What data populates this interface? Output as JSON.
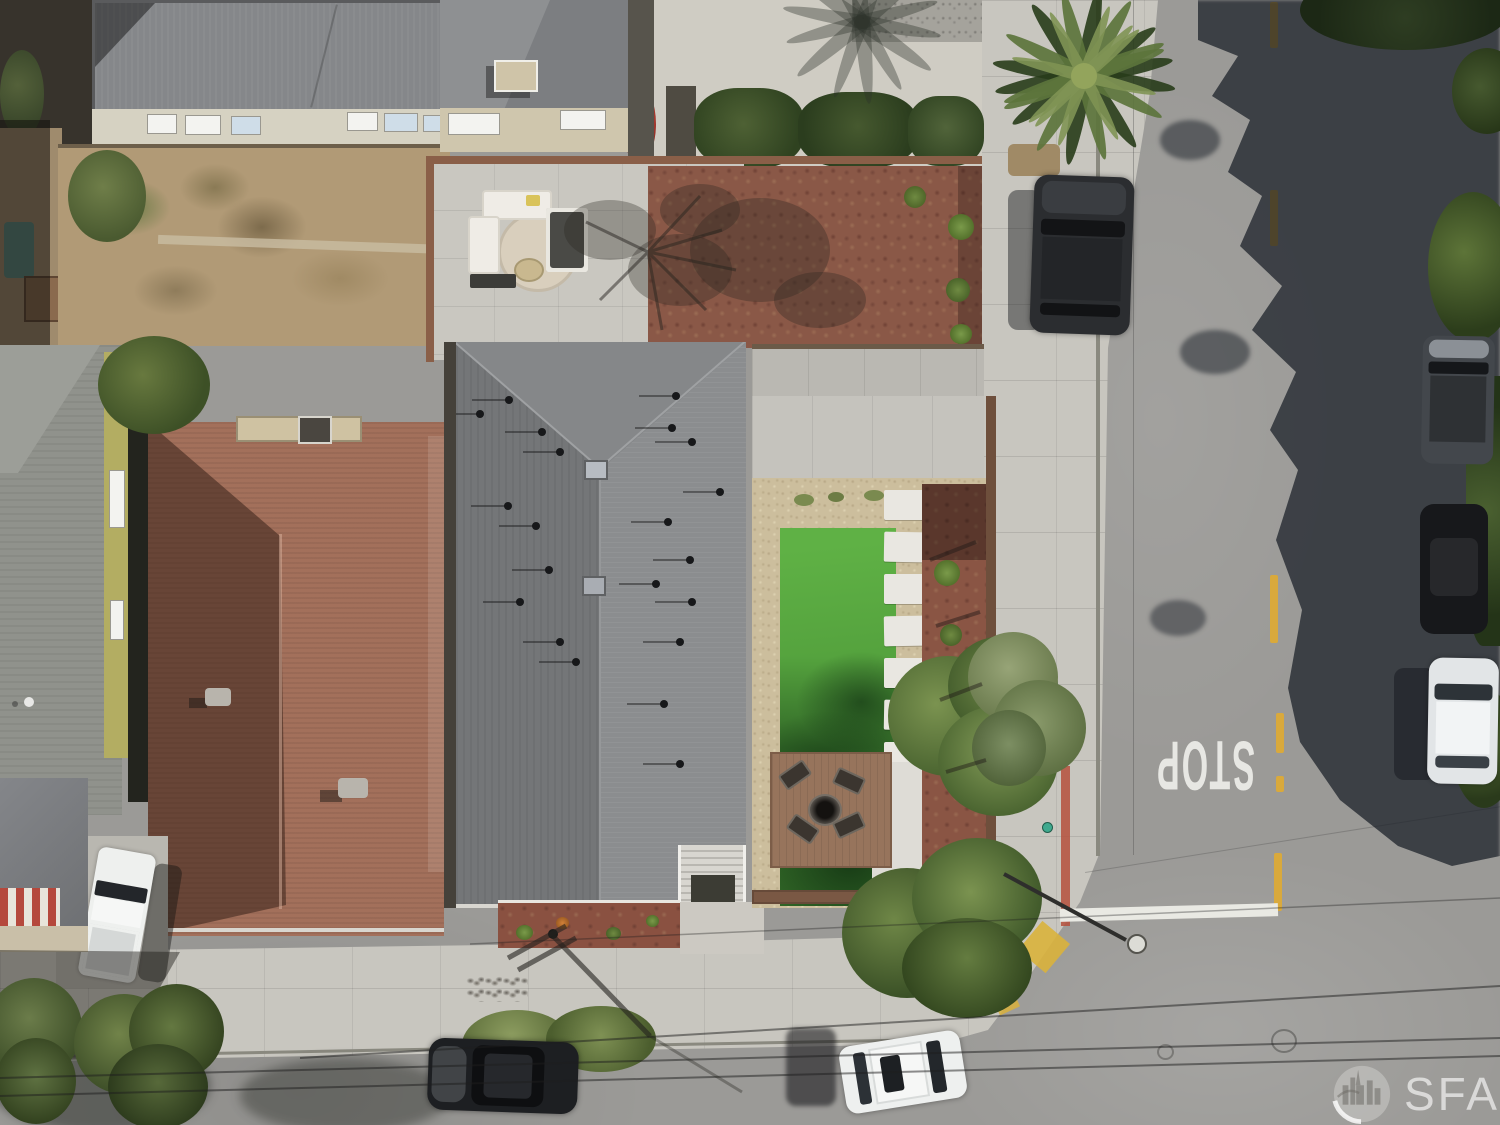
{
  "photo": {
    "kind": "aerial drone photo",
    "subject": "overhead view of residential corner lot: gray shingle-roof home with landscaped yard beside a street intersection",
    "visible_text": [
      "STOP",
      "SFARMLS"
    ]
  },
  "road": {
    "stop_marking": "STOP",
    "stop_marking_rotation_deg": 180,
    "center_line_color": "#d9a93c",
    "limit_line_color": "#e9e9e3",
    "red_curb_color": "#b5503c",
    "curb_ramp_color": "#d9b23c",
    "asphalt_color": "#9b9a97"
  },
  "watermark": {
    "brand": "SFARMLS",
    "logo": "city-skyline-in-circle",
    "text_color": "rgba(255,255,255,0.62)"
  },
  "palette": {
    "main_roof_gray": "#7d7f81",
    "neighbor_roof_red": "#a3705b",
    "neighbor_roof_dark": "#85878a",
    "lawn_green": "#55a33e",
    "mulch_red_brown": "#8a5847",
    "gravel_tan": "#ccbe9d",
    "sidewalk_concrete": "#c8c6bf",
    "deck_wood": "#97745c",
    "tree_shadow": "rgba(24,29,37,0.72)"
  },
  "scene": {
    "vehicles": [
      "dark-suv-parked-top-right",
      "gray-suv-parked-right-edge",
      "black-car-parked-right-edge",
      "white-car-parked-right-edge",
      "black-car-bottom-street",
      "white-suv-bottom-street",
      "white-pickup-left-driveway"
    ],
    "vegetation": [
      "palm-tree",
      "backyard-trees",
      "sidewalk-tree",
      "street-trees",
      "hedges",
      "lawn",
      "mulch-plants"
    ],
    "features": [
      "patio-furniture",
      "fire-pit-deck",
      "stepping-stone-path",
      "entry-stairs",
      "skylights",
      "roof-vents",
      "street-lamp",
      "utility-pole-shadow",
      "power-lines",
      "red-curb",
      "curb-ramp",
      "stop-line",
      "manhole-covers"
    ]
  }
}
